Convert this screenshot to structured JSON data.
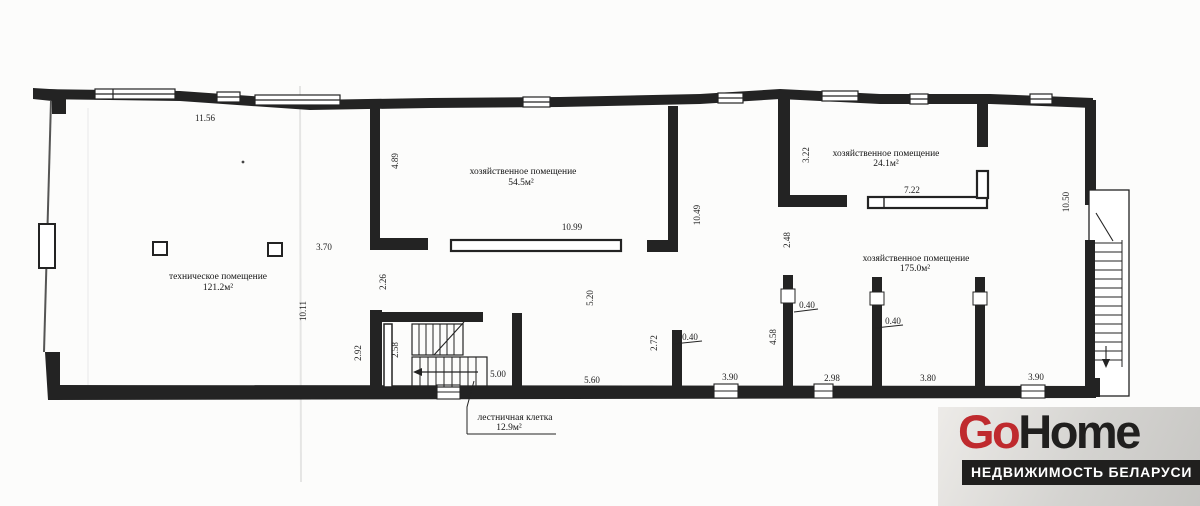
{
  "brand": {
    "go": "Go",
    "home": "Home",
    "tagline": "НЕДВИЖИМОСТЬ БЕЛАРУСИ",
    "go_color": "#bf2a2e",
    "home_color": "#201f1e",
    "tagline_bg": "#201f1e",
    "tagline_fg": "#ffffff"
  },
  "plan": {
    "rooms": [
      {
        "name": "техническое помещение",
        "area": "121.2м²"
      },
      {
        "name": "хозяйственное помещение",
        "area": "54.5м²"
      },
      {
        "name": "хозяйственное помещение",
        "area": "24.1м²"
      },
      {
        "name": "хозяйственное помещение",
        "area": "175.0м²"
      },
      {
        "name": "лестничная клетка",
        "area": "12.9м²"
      }
    ],
    "dims": {
      "top_11_56": "11.56",
      "mid_3_70": "3.70",
      "left_4_89": "4.89",
      "mid_10_99": "10.99",
      "mid_2_26": "2.26",
      "left_10_11": "10.11",
      "stair_2_92": "2.92",
      "stair_2_58": "2.58",
      "stair_5_00": "5.00",
      "mid_5_20": "5.20",
      "bot_5_60": "5.60",
      "mid_2_72": "2.72",
      "w040_a": "0.40",
      "bot_3_90_a": "3.90",
      "mid_10_49": "10.49",
      "mid_4_58": "4.58",
      "w040_b": "0.40",
      "mid_2_48": "2.48",
      "bot_2_98": "2.98",
      "right_3_22": "3.22",
      "right_7_22": "7.22",
      "w040_c": "0.40",
      "bot_3_80": "3.80",
      "bot_3_90_b": "3.90",
      "right_10_50": "10.50"
    }
  }
}
